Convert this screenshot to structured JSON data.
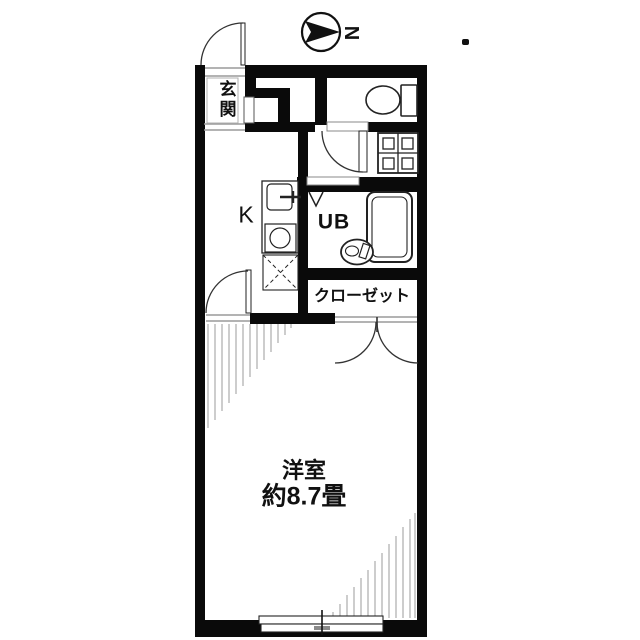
{
  "plan": {
    "type": "apartment-floor-plan",
    "labels": {
      "entrance": "玄関",
      "kitchen": "K",
      "unit_bath": "UB",
      "closet": "クローゼット",
      "main_room": "洋室",
      "main_room_size": "約8.7畳",
      "north": "N"
    },
    "icons": {
      "compass": "north-arrow-icon",
      "toilet": "toilet-icon",
      "bathtub": "bathtub-icon",
      "washbasin": "washbasin-icon",
      "kitchen_sink": "sink-with-faucet-icon",
      "stove": "single-burner-icon",
      "refrigerator_space": "dashed-x-square-icon",
      "washing_machine": "washing-machine-pan-icon",
      "sloped_ceiling": "hatch-lines"
    },
    "colors": {
      "wall": "#0a0a0a",
      "background": "#ffffff",
      "hatch": "#9b9b9b",
      "threshold": "#9a9a9a"
    }
  }
}
